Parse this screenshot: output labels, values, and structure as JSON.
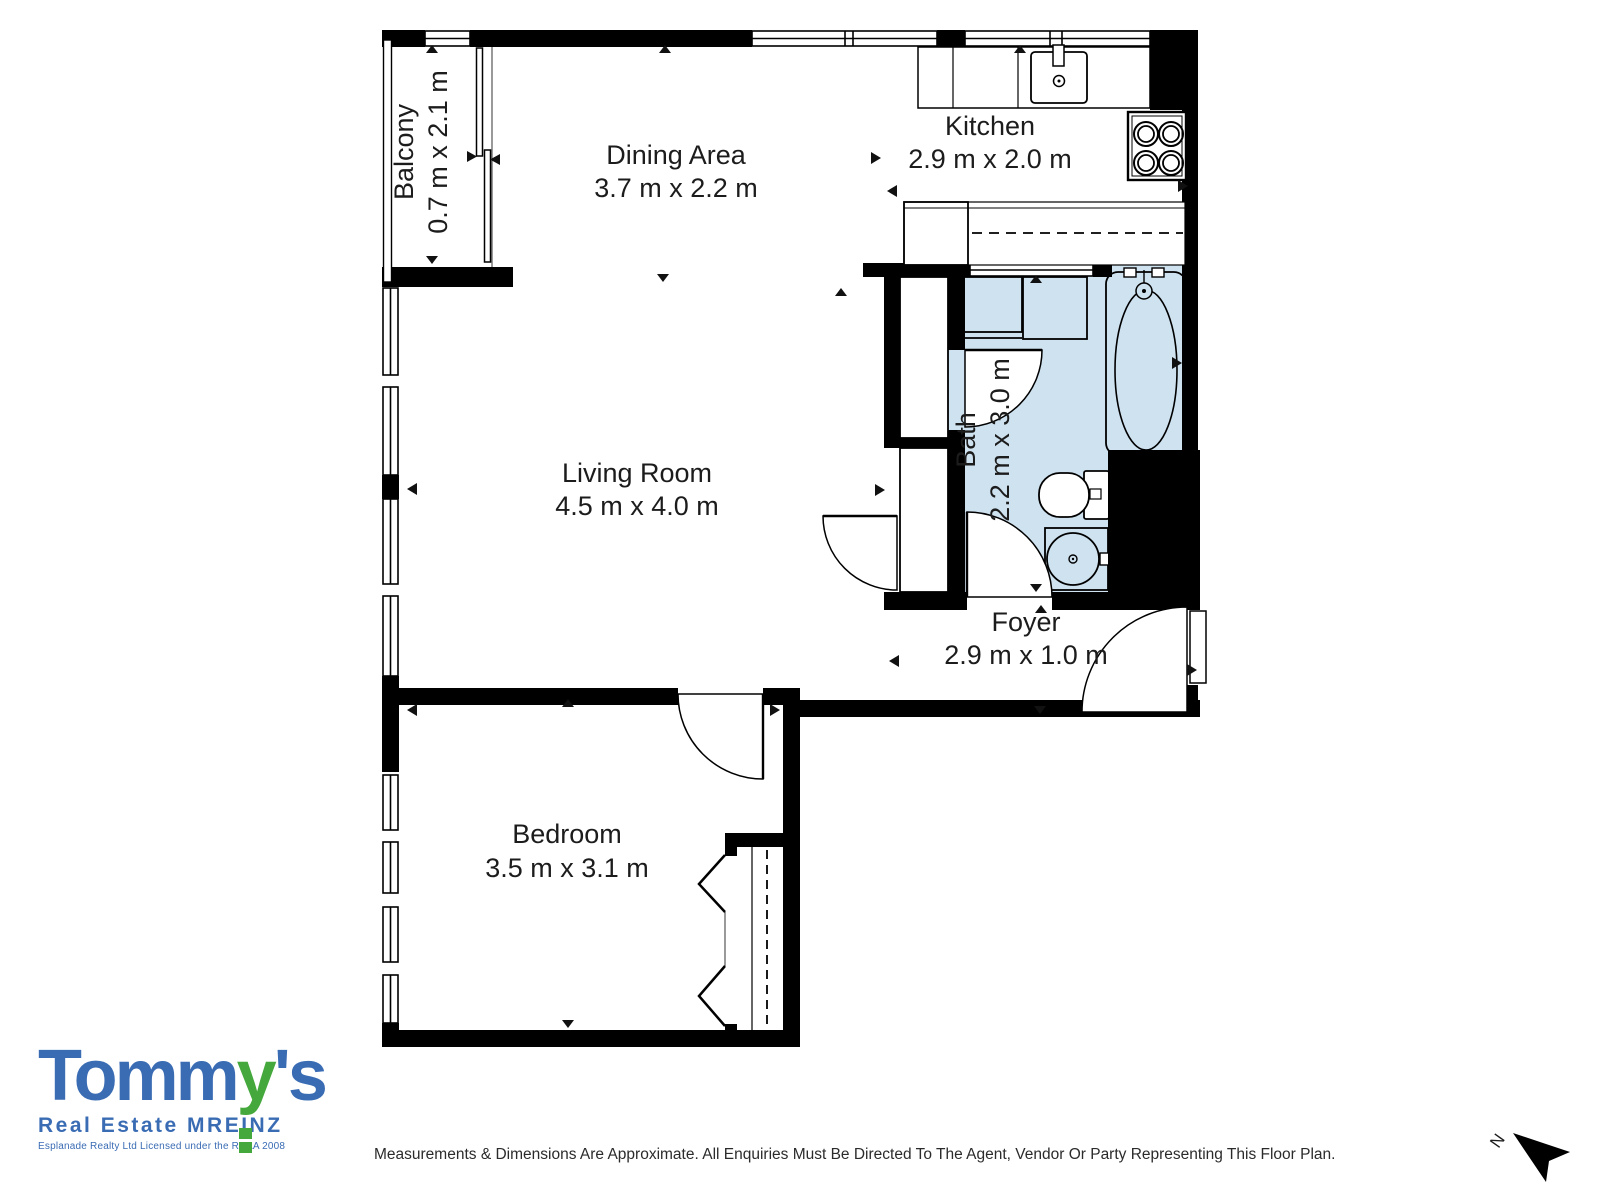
{
  "plan": {
    "rooms": [
      {
        "id": "balcony",
        "name": "Balcony",
        "dims": "0.7 m x 2.1 m"
      },
      {
        "id": "dining",
        "name": "Dining Area",
        "dims": "3.7 m x 2.2 m"
      },
      {
        "id": "kitchen",
        "name": "Kitchen",
        "dims": "2.9 m x 2.0 m"
      },
      {
        "id": "living",
        "name": "Living Room",
        "dims": "4.5 m x 4.0 m"
      },
      {
        "id": "bath",
        "name": "Bath",
        "dims": "2.2 m x 3.0 m"
      },
      {
        "id": "foyer",
        "name": "Foyer",
        "dims": "2.9 m x 1.0 m"
      },
      {
        "id": "bedroom",
        "name": "Bedroom",
        "dims": "3.5 m x 3.1 m"
      }
    ],
    "colors": {
      "wall": "#000000",
      "bath_fill": "#cfe2f0",
      "label_text": "#1c1c1c"
    },
    "compass": {
      "label": "N"
    }
  },
  "logo": {
    "word_part1": "Tomm",
    "word_part2": "y",
    "word_part3": "'s",
    "line2": "Real Estate MREINZ",
    "line3": "Esplanade Realty Ltd Licensed under the REAA 2008",
    "blue": "#3a6cb4",
    "green": "#45a83c"
  },
  "footer": {
    "disclaimer": "Measurements & Dimensions Are Approximate. All Enquiries Must Be Directed To The Agent, Vendor Or Party Representing This Floor Plan."
  }
}
